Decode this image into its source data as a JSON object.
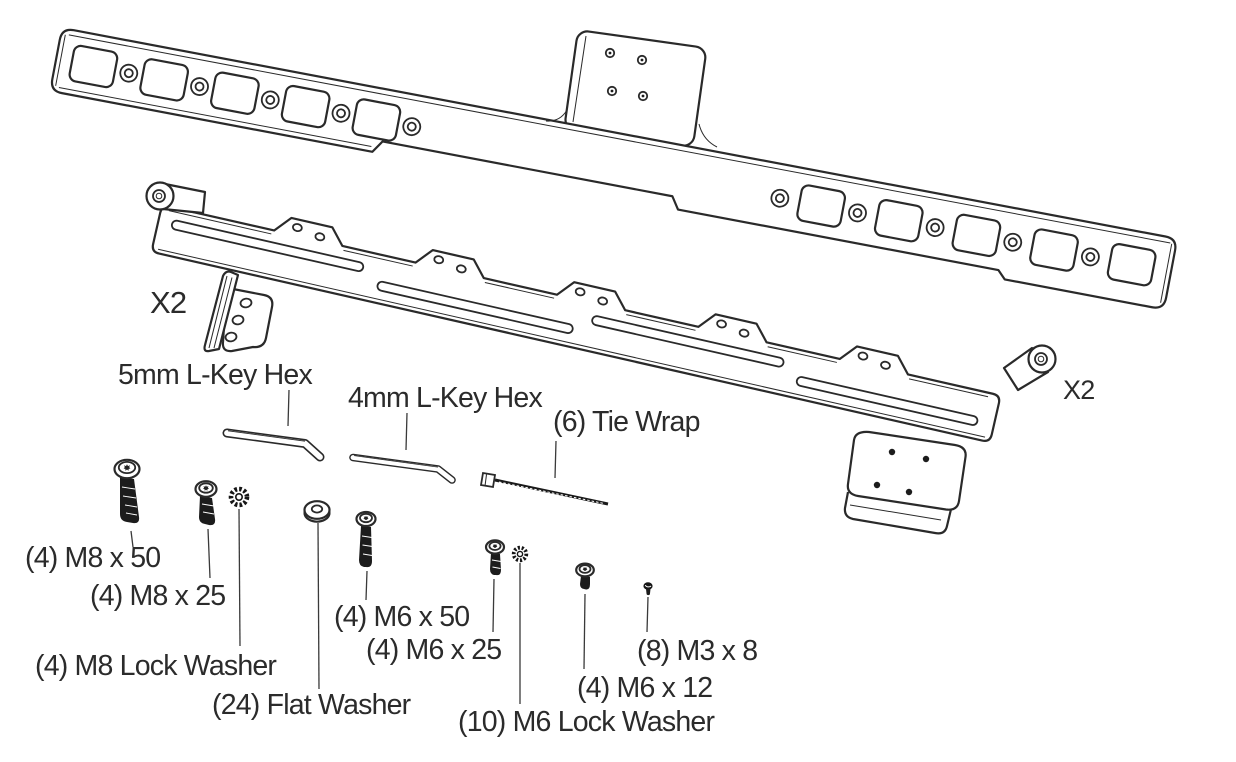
{
  "colors": {
    "background": "#ffffff",
    "line": "#2a2a2a",
    "text": "#2b2b2b",
    "hardware_dark": "#1c1c1c"
  },
  "labels": {
    "qty_corner_bracket": "X2",
    "qty_rail_bracket": "X2",
    "hex_key_5mm": "5mm L-Key Hex",
    "hex_key_4mm": "4mm L-Key Hex",
    "tie_wrap": "(6) Tie Wrap",
    "bolt_m8x50": "(4) M8 x 50",
    "bolt_m8x25": "(4) M8 x 25",
    "m8_lock_washer": "(4) M8 Lock Washer",
    "flat_washer": "(24) Flat Washer",
    "bolt_m6x50": "(4) M6 x 50",
    "bolt_m6x25": "(4) M6 x 25",
    "m6_lock_washer": "(10) M6 Lock Washer",
    "bolt_m6x12": "(4) M6 x 12",
    "bolt_m3x8": "(8) M3 x 8"
  }
}
